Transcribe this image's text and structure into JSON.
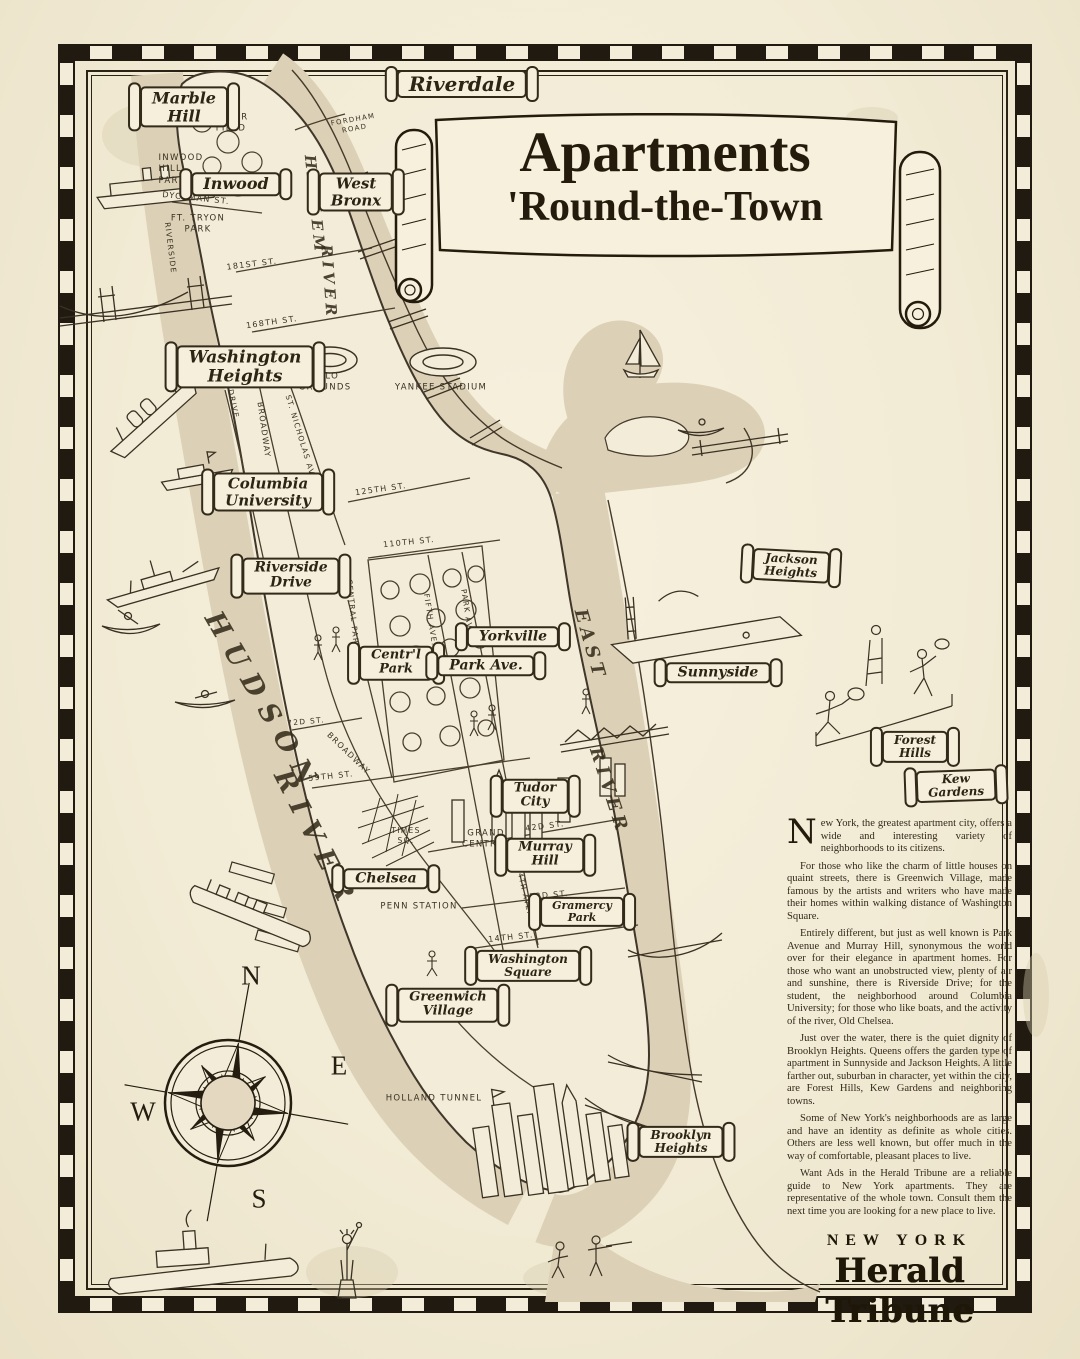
{
  "title": {
    "line1": "Apartments",
    "line2": "'Round-the-Town"
  },
  "banners": {
    "riverdale": "Riverdale",
    "marble_hill": "Marble\nHill",
    "inwood": "Inwood",
    "west_bronx": "West\nBronx",
    "washington_heights": "Washington\nHeights",
    "columbia_university": "Columbia\nUniversity",
    "riverside_drive": "Riverside\nDrive",
    "central_park": "Centr'l\nPark",
    "yorkville": "Yorkville",
    "park_avenue": "Park Ave.",
    "jackson_heights": "Jackson\nHeights",
    "sunnyside": "Sunnyside",
    "forest_hills": "Forest\nHills",
    "kew_gardens": "Kew\nGardens",
    "tudor_city": "Tudor\nCity",
    "murray_hill": "Murray\nHill",
    "chelsea": "Chelsea",
    "gramercy_park": "Gramercy\nPark",
    "washington_square": "Washington\nSquare",
    "greenwich_village": "Greenwich\nVillage",
    "brooklyn_heights": "Brooklyn\nHeights"
  },
  "places": {
    "baker_field": "BAKER\nFIELD",
    "fordham_road": "FORDHAM\nROAD",
    "inwood_hill_park": "INWOOD\nHILL\nPARK",
    "dyckman_st": "DYCKMAN ST.",
    "ft_tryon_park": "FT. TRYON\nPARK",
    "st_181": "181ST ST.",
    "st_168": "168TH ST.",
    "polo_grounds": "POLO\nGROUNDS",
    "yankee_stadium": "YANKEE STADIUM",
    "st_125": "125TH ST.",
    "st_110": "110TH ST.",
    "st_72": "72D ST.",
    "st_59": "59TH ST.",
    "times_sq": "TIMES\nSQ.",
    "grand_central": "GRAND\nCENTRAL",
    "st_42": "42D ST.",
    "st_23": "23D ST.",
    "penn_station": "PENN STATION",
    "st_14": "14TH ST.",
    "holland_tunnel": "HOLLAND TUNNEL"
  },
  "streets": {
    "riverside": "RIVERSIDE",
    "drive": "DRIVE",
    "broadway_upper": "BROADWAY",
    "st_nicholas_ave": "ST. NICHOLAS AVE.",
    "central_park_west": "CENTRAL PARK WEST",
    "fifth_ave": "FIFTH AVE.",
    "park_ave": "PARK AVE.",
    "broadway_mid": "BROADWAY",
    "fourth_ave": "4TH AVE."
  },
  "rivers": {
    "hudson_word1": "HUDSON",
    "hudson_word2": "RIVER",
    "harlem_word1": "HARLEM",
    "harlem_word2": "RIVER",
    "east_word1": "EAST",
    "east_word2": "RIVER"
  },
  "compass": {
    "north": "N",
    "east": "E",
    "south": "S",
    "west": "W"
  },
  "article": {
    "drop_cap": "N",
    "p1_rest": "ew York, the greatest apartment city, offers a wide and interesting variety of neighborhoods to its citizens.",
    "p2": "For those who like the charm of little houses on quaint streets, there is Greenwich Village, made famous by the artists and writers who have made their homes within walking distance of Washington Square.",
    "p3": "Entirely different, but just as well known is Park Avenue and Murray Hill, synonymous the world over for their elegance in apartment homes. For those who want an unobstructed view, plenty of air and sunshine, there is Riverside Drive; for the student, the neighborhood around Columbia University; for those who like boats, and the activity of the river, Old Chelsea.",
    "p4": "Just over the water, there is the quiet dignity of Brooklyn Heights. Queens offers the garden type of apartment in Sunnyside and Jackson Heights. A little farther out, suburban in character, yet within the city, are Forest Hills, Kew Gardens and neighboring towns.",
    "p5": "Some of New York's neighborhoods are as large and have an identity as definite as whole cities. Others are less well known, but offer much in the way of comfortable, pleasant places to live.",
    "p6": "Want Ads in the Herald Tribune are a reliable guide to New York apartments. They are representative of the whole town. Consult them the next time you are looking for a new place to live."
  },
  "publisher": {
    "city": "NEW YORK",
    "name": "Herald Tribune"
  },
  "colors": {
    "paper": "#f3ecd8",
    "ink": "#3a3123",
    "water_tan": "#dcd1b6",
    "border_black": "#211a10"
  }
}
